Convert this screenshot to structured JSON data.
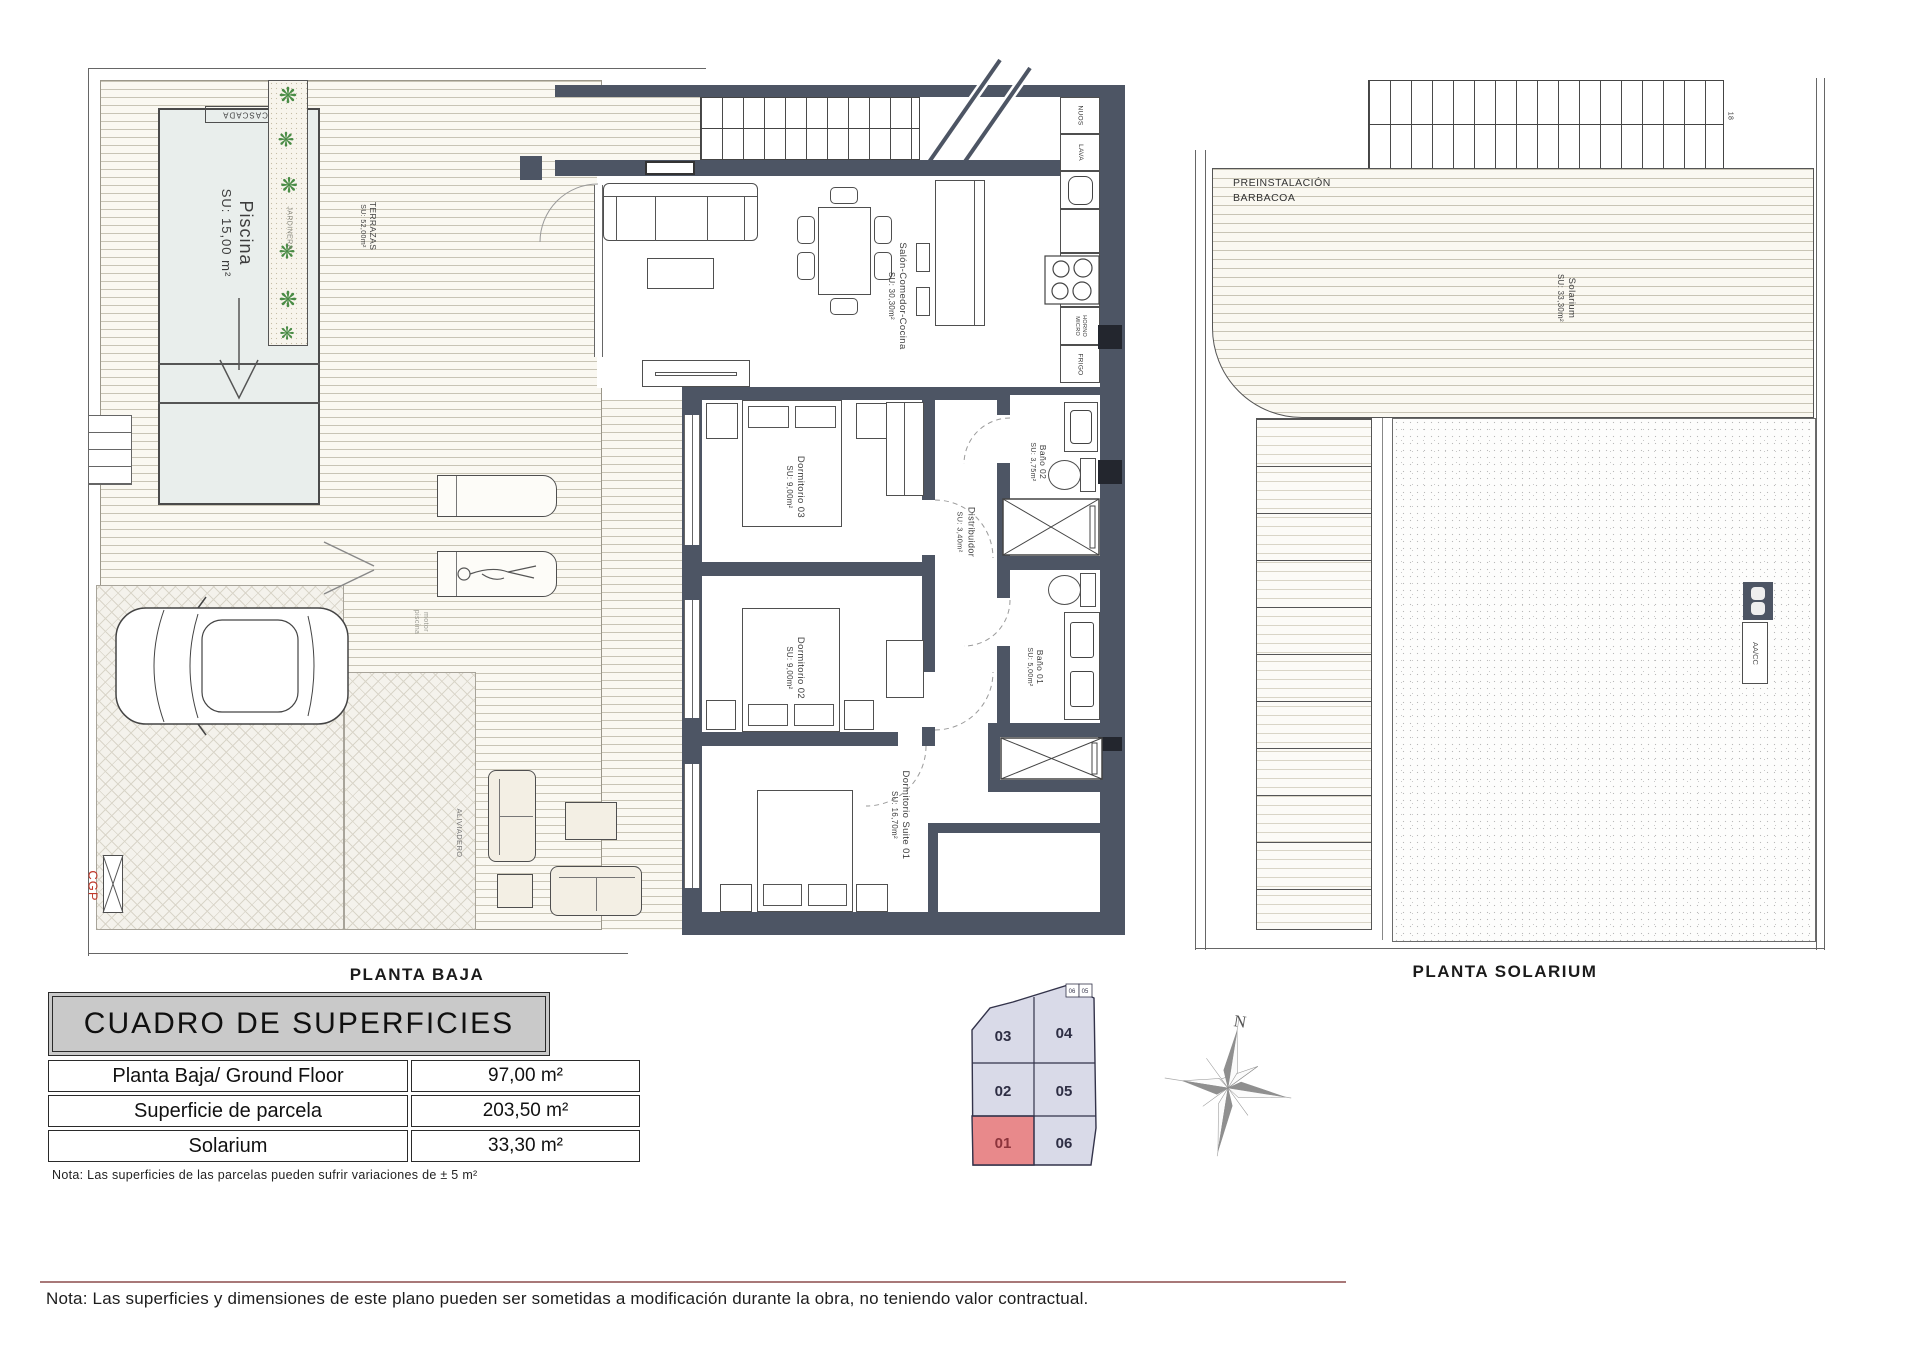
{
  "planta_baja": {
    "title": "PLANTA BAJA",
    "pool": {
      "name": "Piscina",
      "area": "SU: 15,00 m²",
      "cascada_label": "CASCADA"
    },
    "planter": {
      "label": "JARDINERA"
    },
    "terrace": {
      "name": "TERRAZAS",
      "area": "SU: 52,00m²"
    },
    "rooms": {
      "salon": {
        "name": "Salón-Comedor-Cocina",
        "area": "SU: 30,30m²"
      },
      "dormitorio03": {
        "name": "Dormitorio 03",
        "area": "SU: 9,00m²"
      },
      "dormitorio02": {
        "name": "Dormitorio 02",
        "area": "SU: 9,00m²"
      },
      "suite": {
        "name": "Dormitorio Suite 01",
        "area": "SU: 16,70m²"
      },
      "distribuidor": {
        "name": "Distribuidor",
        "area": "SU: 3,40m²"
      },
      "bano02": {
        "name": "Baño 02",
        "area": "SU: 3,75m²"
      },
      "bano01": {
        "name": "Baño 01",
        "area": "SU: 5,00m²"
      }
    },
    "kitchen": {
      "c1": "NUOS",
      "c2": "LAVA",
      "c3": "HORNO\nMICRO",
      "c4": "FRIGO"
    },
    "labels": {
      "aliviadero": "ALIVIADERO",
      "motor": "motor\npiscina",
      "cgp": "CGP"
    }
  },
  "solarium": {
    "title": "PLANTA SOLARIUM",
    "barbacoa": "PREINSTALACIÓN\nBARBACOA",
    "room": {
      "name": "Solarium",
      "area": "SU: 33,30m²"
    },
    "aacc": "AA/CC",
    "stair_number": "18"
  },
  "surfaces_table": {
    "title": "CUADRO DE SUPERFICIES",
    "rows": [
      {
        "label": "Planta Baja/ Ground Floor",
        "value": "97,00 m²"
      },
      {
        "label": "Superficie de parcela",
        "value": "203,50 m²"
      },
      {
        "label": "Solarium",
        "value": "33,30 m²"
      }
    ],
    "note": "Nota: Las superficies de las parcelas pueden sufrir variaciones de ± 5 m²"
  },
  "site_map": {
    "units": {
      "u03": "03",
      "u04": "04",
      "u02": "02",
      "u05": "05",
      "u01": "01",
      "u06": "06"
    },
    "corner": {
      "a": "06",
      "b": "05"
    },
    "highlighted_unit": "01"
  },
  "compass": {
    "north": "N"
  },
  "footer": {
    "note": "Nota: Las superficies y dimensiones de este plano pueden ser sometidas a modificación durante la obra, no teniendo valor contractual."
  },
  "colors": {
    "wall": "#4d5564",
    "pool": "#e9eeec",
    "unit_highlight": "#e8898b",
    "unit_cell": "#d9dae8",
    "footer_line": "#a87878",
    "cgp_red": "#c0392b"
  }
}
